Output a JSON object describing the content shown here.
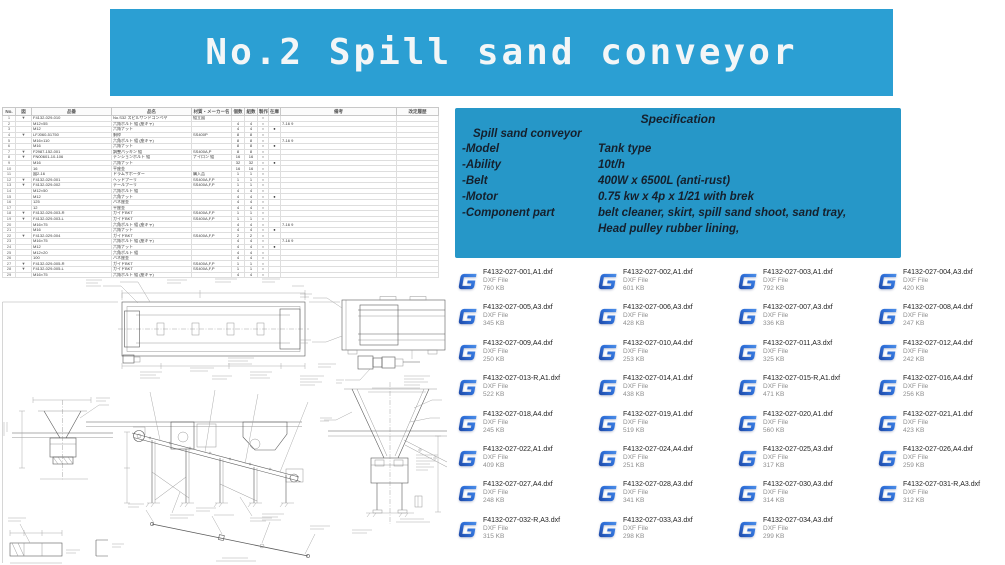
{
  "banner": {
    "text": "No.2 Spill sand conveyor",
    "bg_color": "#2B9FD3",
    "text_color": "#F3F6F7"
  },
  "spec_box": {
    "bg_color": "#2697C8",
    "title": "Specification",
    "subtitle": "Spill sand conveyor",
    "rows": [
      {
        "label": "-Model",
        "value": "Tank type"
      },
      {
        "label": "-Ability",
        "value": "10t/h"
      },
      {
        "label": "-Belt",
        "value": "400W x 6500L (anti-rust)"
      },
      {
        "label": "-Motor",
        "value": "0.75 kw x 4p x 1/21 with brek"
      },
      {
        "label": "-Component part",
        "value": "belt cleaner, skirt, spill sand shoot, sand tray,",
        "value2": "Head pulley rubber lining,"
      }
    ]
  },
  "parts_table": {
    "headers": [
      "No.",
      "図",
      "品番",
      "品名",
      "材質・メーカー名",
      "個数",
      "組数",
      "製作",
      "在庫",
      "備考",
      "改定履歴"
    ],
    "rows": [
      [
        "1",
        "▼",
        "F4132-029-010",
        "No.S32 スピルサンドコンベヤ",
        "組立図",
        "",
        "",
        "○",
        "",
        "",
        ""
      ],
      [
        "2",
        "",
        "M12×55",
        "六角ボルト 組 (座キャ)",
        "",
        "4",
        "4",
        "○",
        "",
        "7-16 9",
        ""
      ],
      [
        "3",
        "",
        "M12",
        "六角ナット",
        "",
        "4",
        "4",
        "○",
        "●",
        "",
        ""
      ],
      [
        "4",
        "▼",
        "LFJ060-51750",
        "胴枠",
        "SS400P",
        "8",
        "8",
        "○",
        "",
        "",
        ""
      ],
      [
        "5",
        "",
        "M16×110",
        "六角ボルト 組 (座キャ)",
        "",
        "8",
        "8",
        "○",
        "",
        "7-16 9",
        ""
      ],
      [
        "6",
        "",
        "M16",
        "六角ナット",
        "",
        "8",
        "8",
        "○",
        "●",
        "",
        ""
      ],
      [
        "7",
        "▼",
        "F2987-152-001",
        "調整パッキン 組",
        "SS400A,P",
        "8",
        "8",
        "○",
        "",
        "",
        ""
      ],
      [
        "8",
        "▼",
        "FN00601-10-106",
        "テンションボルト 組",
        "ナイロン 組",
        "16",
        "16",
        "○",
        "",
        "",
        ""
      ],
      [
        "9",
        "",
        "M16",
        "六角ナット",
        "",
        "32",
        "32",
        "○",
        "●",
        "",
        ""
      ],
      [
        "10",
        "",
        "16",
        "平座金",
        "",
        "16",
        "16",
        "○",
        "",
        "",
        ""
      ],
      [
        "11",
        "",
        "図2-16",
        "ドラムサポーター",
        "購入品",
        "1",
        "1",
        "○",
        "",
        "",
        ""
      ],
      [
        "12",
        "▼",
        "F4132-029-001",
        "ヘッドプーリ",
        "SS400A,F,P",
        "1",
        "1",
        "○",
        "",
        "",
        ""
      ],
      [
        "13",
        "▼",
        "F4132-029-002",
        "テールプーリ",
        "SS400A,F,P",
        "1",
        "1",
        "○",
        "",
        "",
        ""
      ],
      [
        "14",
        "",
        "M12×50",
        "六角ボルト 組",
        "",
        "4",
        "4",
        "○",
        "",
        "",
        ""
      ],
      [
        "15",
        "",
        "M12",
        "六角ナット",
        "",
        "4",
        "4",
        "○",
        "●",
        "",
        ""
      ],
      [
        "16",
        "",
        "125",
        "バネ座金",
        "",
        "4",
        "4",
        "○",
        "",
        "",
        ""
      ],
      [
        "17",
        "",
        "12",
        "平座金",
        "",
        "4",
        "4",
        "○",
        "",
        "",
        ""
      ],
      [
        "18",
        "▼",
        "F4132-029-003-R",
        "ガイドBKT",
        "SS400A,F,P",
        "1",
        "1",
        "○",
        "",
        "",
        ""
      ],
      [
        "19",
        "▼",
        "F4132-029-003-L",
        "ガイドBKT",
        "SS400A,F,P",
        "1",
        "1",
        "○",
        "",
        "",
        ""
      ],
      [
        "20",
        "",
        "M16×75",
        "六角ボルト 組 (座キャ)",
        "",
        "4",
        "4",
        "○",
        "",
        "7-16 9",
        ""
      ],
      [
        "21",
        "",
        "M16",
        "六角ナット",
        "",
        "4",
        "4",
        "○",
        "●",
        "",
        ""
      ],
      [
        "22",
        "▼",
        "F4132-029-004",
        "ガイドBKT",
        "SS400A,F,P",
        "2",
        "2",
        "○",
        "",
        "",
        ""
      ],
      [
        "23",
        "",
        "M16×75",
        "六角ボルト 組 (座キャ)",
        "",
        "4",
        "4",
        "○",
        "",
        "7-16 9",
        ""
      ],
      [
        "24",
        "",
        "M12",
        "六角ナット",
        "",
        "4",
        "4",
        "○",
        "●",
        "",
        ""
      ],
      [
        "25",
        "",
        "M12×20",
        "六角ボルト 組",
        "",
        "4",
        "4",
        "○",
        "",
        "",
        ""
      ],
      [
        "26",
        "",
        "100",
        "バネ座金",
        "",
        "4",
        "4",
        "○",
        "",
        "",
        ""
      ],
      [
        "27",
        "▼",
        "F4132-029-005-R",
        "ガイドBKT",
        "SS400A,F,P",
        "1",
        "1",
        "○",
        "",
        "",
        ""
      ],
      [
        "28",
        "▼",
        "F4132-029-005-L",
        "ガイドBKT",
        "SS400A,F,P",
        "1",
        "1",
        "○",
        "",
        "",
        ""
      ],
      [
        "29",
        "",
        "M16×75",
        "六角ボルト 組 (座キャ)",
        "",
        "4",
        "4",
        "○",
        "",
        "",
        ""
      ]
    ]
  },
  "files": {
    "type_label": "DXF File",
    "icon": "draftsight-g-icon",
    "icon_color": "#2a5bd7",
    "items": [
      {
        "name": "F4132-027-001,A1.dxf",
        "size": "760 KB"
      },
      {
        "name": "F4132-027-002,A1.dxf",
        "size": "601 KB"
      },
      {
        "name": "F4132-027-003,A1.dxf",
        "size": "792 KB"
      },
      {
        "name": "F4132-027-004,A3.dxf",
        "size": "420 KB"
      },
      {
        "name": "F4132-027-005,A3.dxf",
        "size": "345 KB"
      },
      {
        "name": "F4132-027-006,A3.dxf",
        "size": "428 KB"
      },
      {
        "name": "F4132-027-007,A3.dxf",
        "size": "336 KB"
      },
      {
        "name": "F4132-027-008,A4.dxf",
        "size": "247 KB"
      },
      {
        "name": "F4132-027-009,A4.dxf",
        "size": "250 KB"
      },
      {
        "name": "F4132-027-010,A4.dxf",
        "size": "253 KB"
      },
      {
        "name": "F4132-027-011,A3.dxf",
        "size": "325 KB"
      },
      {
        "name": "F4132-027-012,A4.dxf",
        "size": "242 KB"
      },
      {
        "name": "F4132-027-013-R,A1.dxf",
        "size": "522 KB"
      },
      {
        "name": "F4132-027-014,A1.dxf",
        "size": "438 KB"
      },
      {
        "name": "F4132-027-015-R,A1.dxf",
        "size": "471 KB"
      },
      {
        "name": "F4132-027-016,A4.dxf",
        "size": "256 KB"
      },
      {
        "name": "F4132-027-018,A4.dxf",
        "size": "245 KB"
      },
      {
        "name": "F4132-027-019,A1.dxf",
        "size": "519 KB"
      },
      {
        "name": "F4132-027-020,A1.dxf",
        "size": "560 KB"
      },
      {
        "name": "F4132-027-021,A1.dxf",
        "size": "423 KB"
      },
      {
        "name": "F4132-027-022,A1.dxf",
        "size": "409 KB"
      },
      {
        "name": "F4132-027-024,A4.dxf",
        "size": "251 KB"
      },
      {
        "name": "F4132-027-025,A3.dxf",
        "size": "317 KB"
      },
      {
        "name": "F4132-027-026,A4.dxf",
        "size": "259 KB"
      },
      {
        "name": "F4132-027-027,A4.dxf",
        "size": "248 KB"
      },
      {
        "name": "F4132-027-028,A3.dxf",
        "size": "341 KB"
      },
      {
        "name": "F4132-027-030,A3.dxf",
        "size": "314 KB"
      },
      {
        "name": "F4132-027-031-R,A3.dxf",
        "size": "312 KB"
      },
      {
        "name": "F4132-027-032-R,A3.dxf",
        "size": "315 KB"
      },
      {
        "name": "F4132-027-033,A3.dxf",
        "size": "298 KB"
      },
      {
        "name": "F4132-027-034,A3.dxf",
        "size": "299 KB"
      }
    ]
  }
}
